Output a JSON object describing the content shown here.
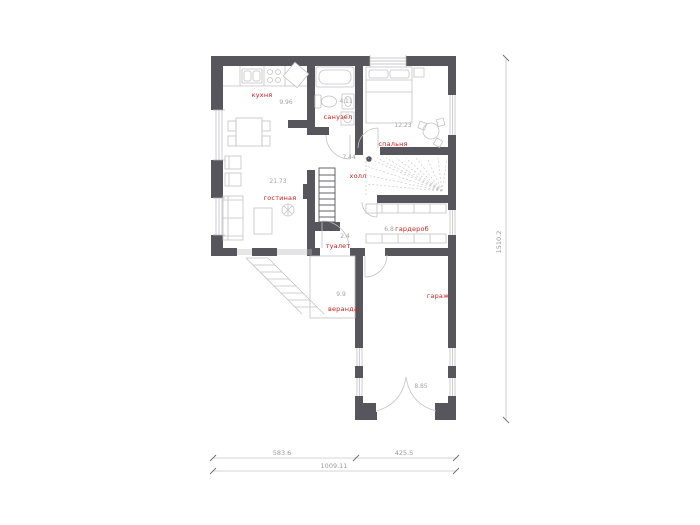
{
  "plan": {
    "title": "floor-plan-ground-level",
    "rooms": {
      "kitchen": {
        "label": "кухня",
        "area": "9.96"
      },
      "living": {
        "label": "гостиная",
        "area": "21.73"
      },
      "bathroom": {
        "label": "санузел",
        "area": "4.11"
      },
      "bedroom": {
        "label": "спальня",
        "area": "12.23"
      },
      "hall": {
        "label": "холл",
        "area": "7.44"
      },
      "wardrobe": {
        "label": "гардероб",
        "area": "6.8"
      },
      "wc": {
        "label": "туалет",
        "area": "2.4"
      },
      "porch": {
        "label": "веранда",
        "area": "9.9"
      },
      "garage": {
        "label": "гараж",
        "area": "8.85"
      }
    },
    "dimensions": {
      "bottom_left_segment": "583.6",
      "bottom_right_segment": "425.5",
      "bottom_total": "1009.11",
      "right_total": "1510.2"
    },
    "icons": [
      "bed",
      "bathtub",
      "toilet",
      "sink",
      "washing-machine",
      "sofa",
      "armchair",
      "coffee-table",
      "plant",
      "tv",
      "dining-table",
      "kitchen-counter",
      "kitchen-sink",
      "stove",
      "corner-cabinet",
      "round-table",
      "shelves",
      "winder-stairs",
      "straight-stairs",
      "door-arc",
      "window",
      "entry-steps"
    ],
    "colors": {
      "wall": "#56565c",
      "thin_line": "#c3c3c6",
      "room_label": "#cc1e1e",
      "muted_text": "#9a9a9a",
      "background": "#ffffff"
    }
  }
}
